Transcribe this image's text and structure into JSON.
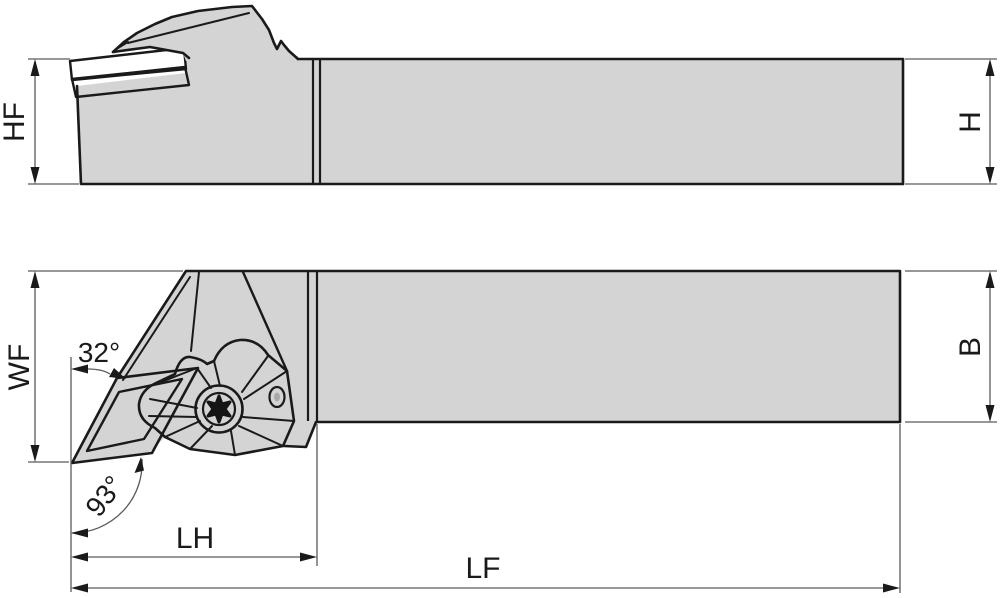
{
  "drawing": {
    "type": "tool-holder-dimension-drawing",
    "views": {
      "side": {
        "labels": {
          "hf": "HF",
          "h": "H"
        }
      },
      "plan": {
        "labels": {
          "wf": "WF",
          "b": "B",
          "lh": "LH",
          "lf": "LF",
          "angle_back": "32°",
          "angle_lead": "93°"
        }
      }
    },
    "colors": {
      "body": "#d4d4d4",
      "insert": "#f6a41e",
      "shim": "#9a9a9a",
      "outline": "#1a1a1a",
      "dimension": "#5a5a5a",
      "screw_ring": "#c9c9c9",
      "screw_inner": "#a9a9a9",
      "background": "#ffffff"
    }
  }
}
